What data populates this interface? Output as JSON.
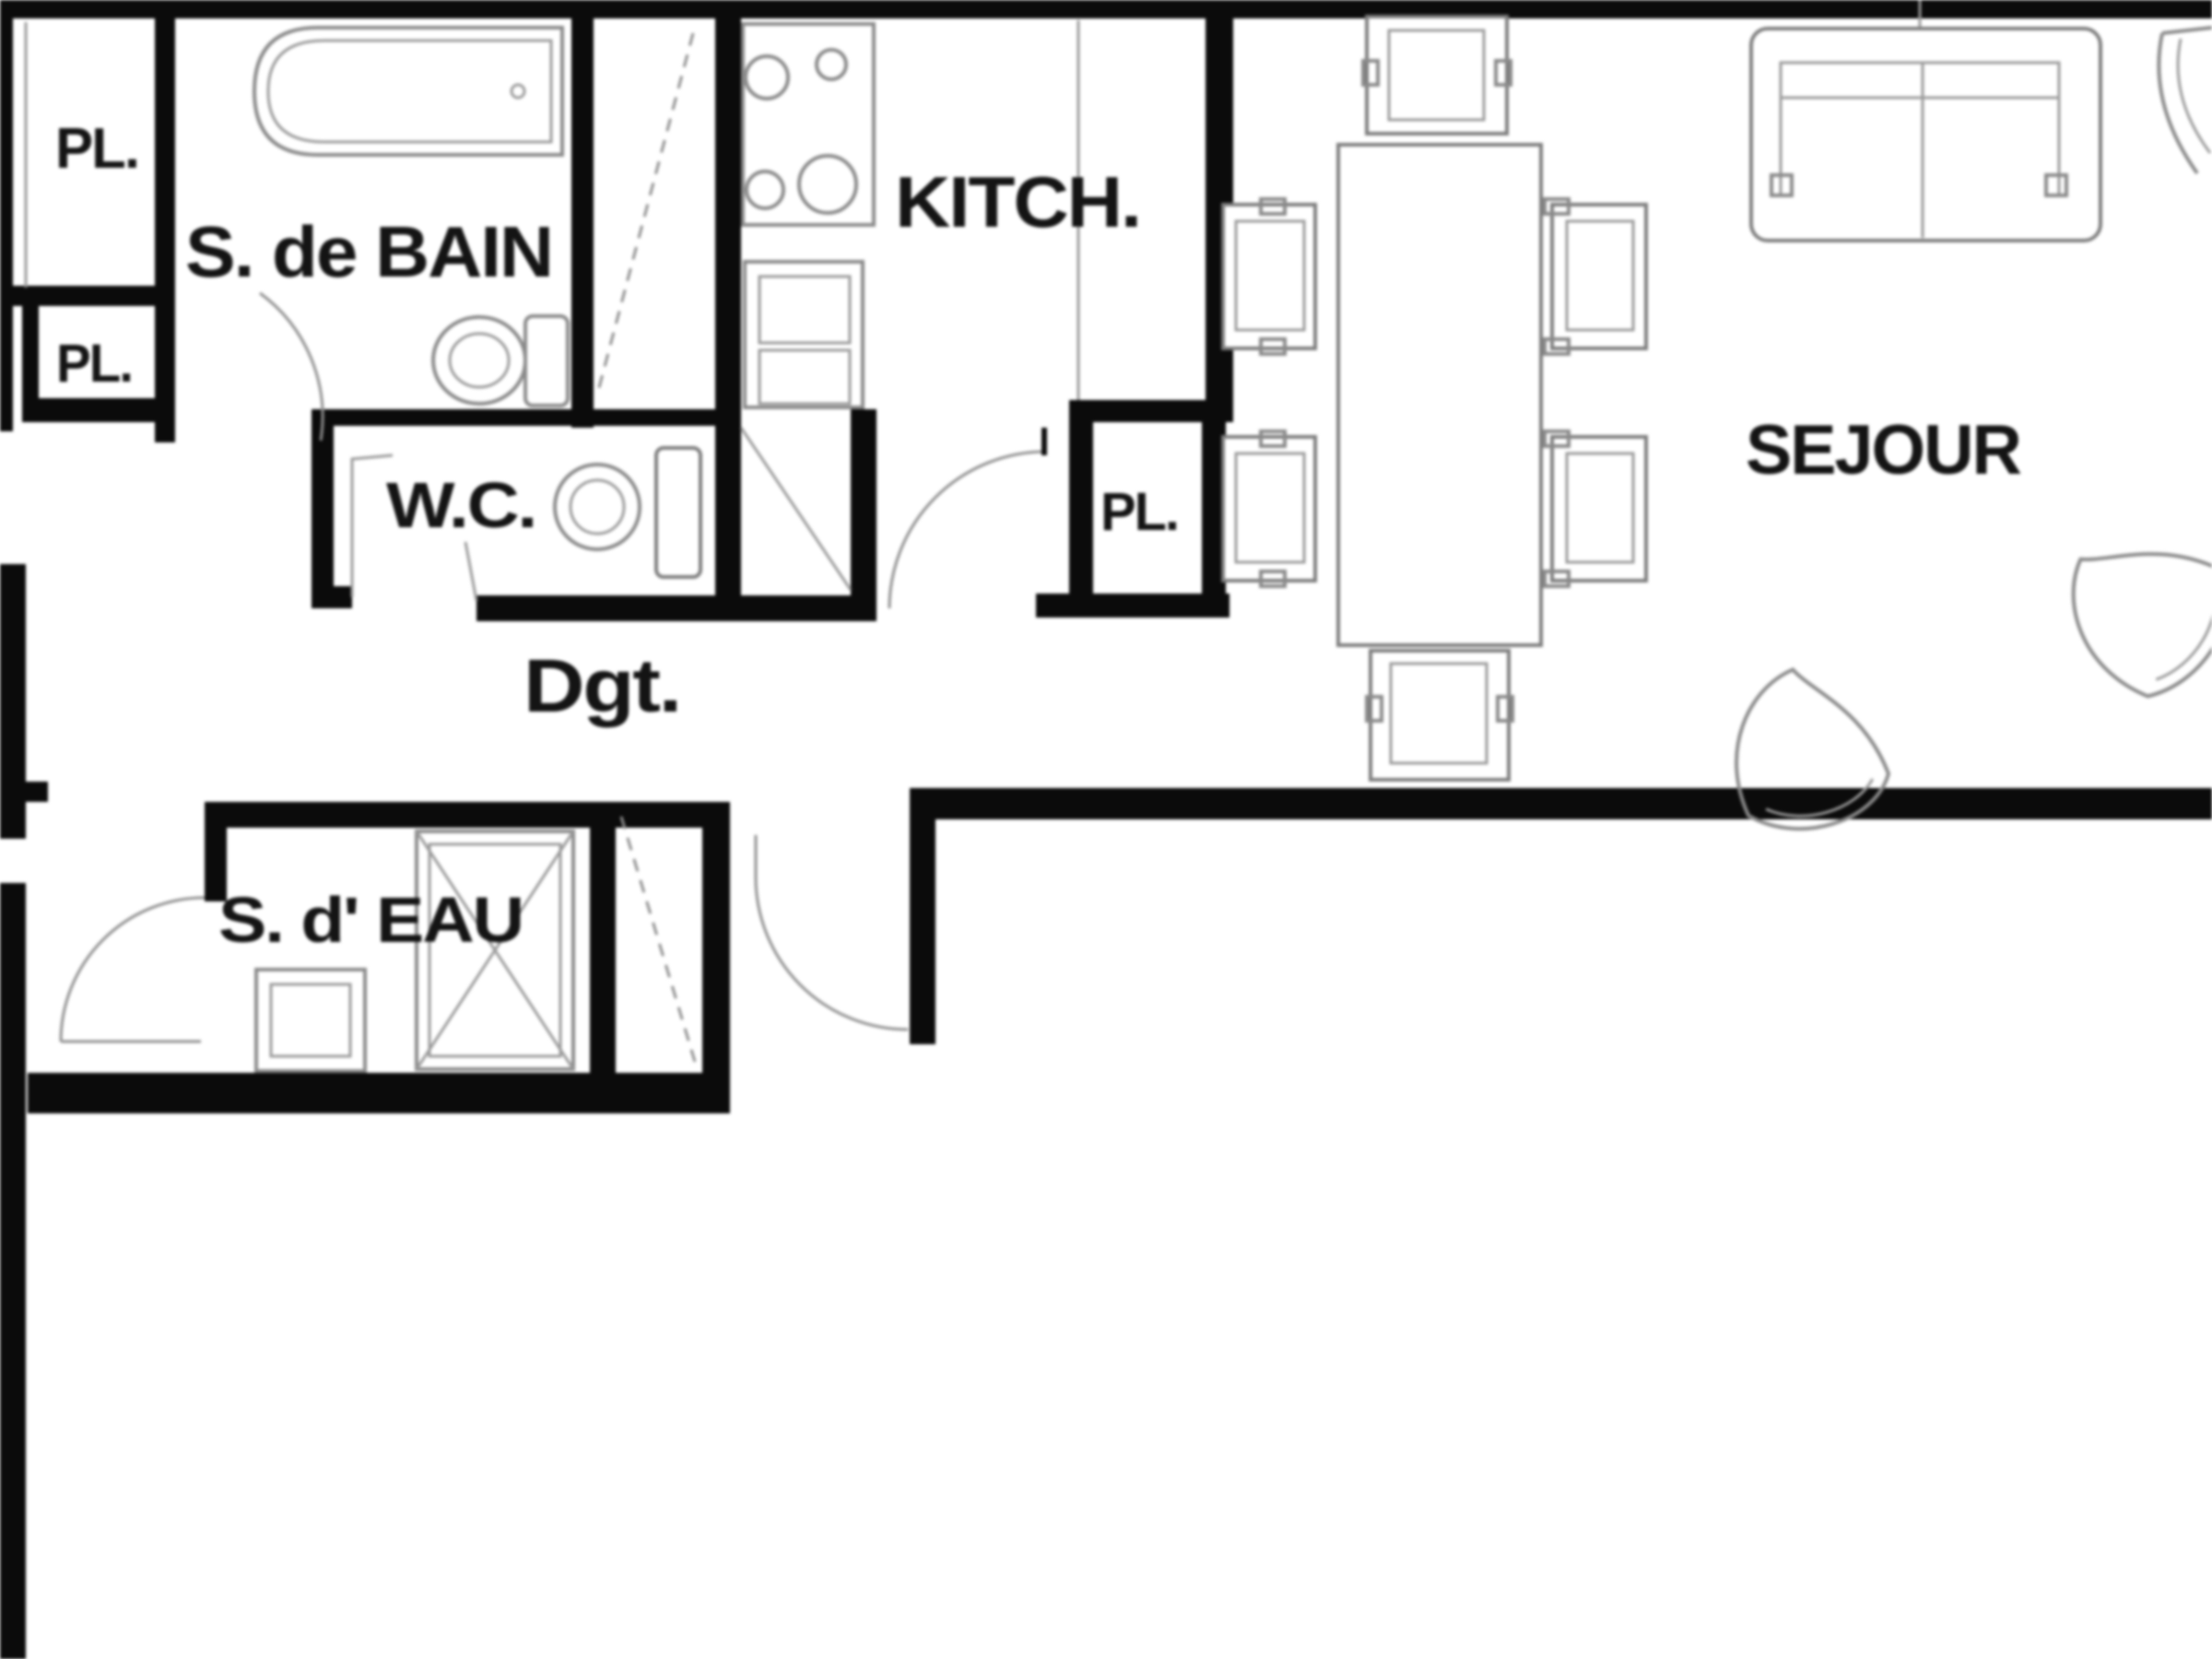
{
  "plan": {
    "type": "apartment-floor-plan",
    "language": "fr",
    "background": "#ffffff"
  },
  "palette": {
    "wall": "#0b0b0b",
    "furniture": "#8a8a8a",
    "label": "#141414",
    "background": "#ffffff"
  },
  "rooms": [
    {
      "id": "placard-upper-left",
      "label": "PL."
    },
    {
      "id": "placard-lower-left",
      "label": "PL."
    },
    {
      "id": "salle-de-bain",
      "label": "S. de BAIN"
    },
    {
      "id": "wc",
      "label": "W.C."
    },
    {
      "id": "kitchen",
      "label": "KITCH."
    },
    {
      "id": "placard-kitchen",
      "label": "PL."
    },
    {
      "id": "degagement",
      "label": "Dgt."
    },
    {
      "id": "salle-d-eau",
      "label": "S. d' EAU"
    },
    {
      "id": "sejour",
      "label": "SEJOUR"
    }
  ],
  "fixtures": [
    {
      "name": "bathtub",
      "room": "salle-de-bain"
    },
    {
      "name": "toilet",
      "room": "salle-de-bain"
    },
    {
      "name": "toilet",
      "room": "wc"
    },
    {
      "name": "cooktop-four-burners",
      "room": "kitchen"
    },
    {
      "name": "sink-counter-unit",
      "room": "kitchen"
    },
    {
      "name": "duct-shaft-diagonal",
      "room": "wc"
    },
    {
      "name": "dining-table",
      "room": "sejour"
    },
    {
      "name": "dining-chair",
      "room": "sejour",
      "count": 6
    },
    {
      "name": "sofa-two-seat",
      "room": "sejour"
    },
    {
      "name": "fan-armchair",
      "room": "sejour",
      "count": 2
    },
    {
      "name": "corner-armchair",
      "room": "sejour"
    },
    {
      "name": "washbasin",
      "room": "salle-d-eau"
    },
    {
      "name": "shower",
      "room": "salle-d-eau"
    },
    {
      "name": "door-swing",
      "count": 5
    },
    {
      "name": "sliding-door-dashed",
      "count": 2
    }
  ]
}
